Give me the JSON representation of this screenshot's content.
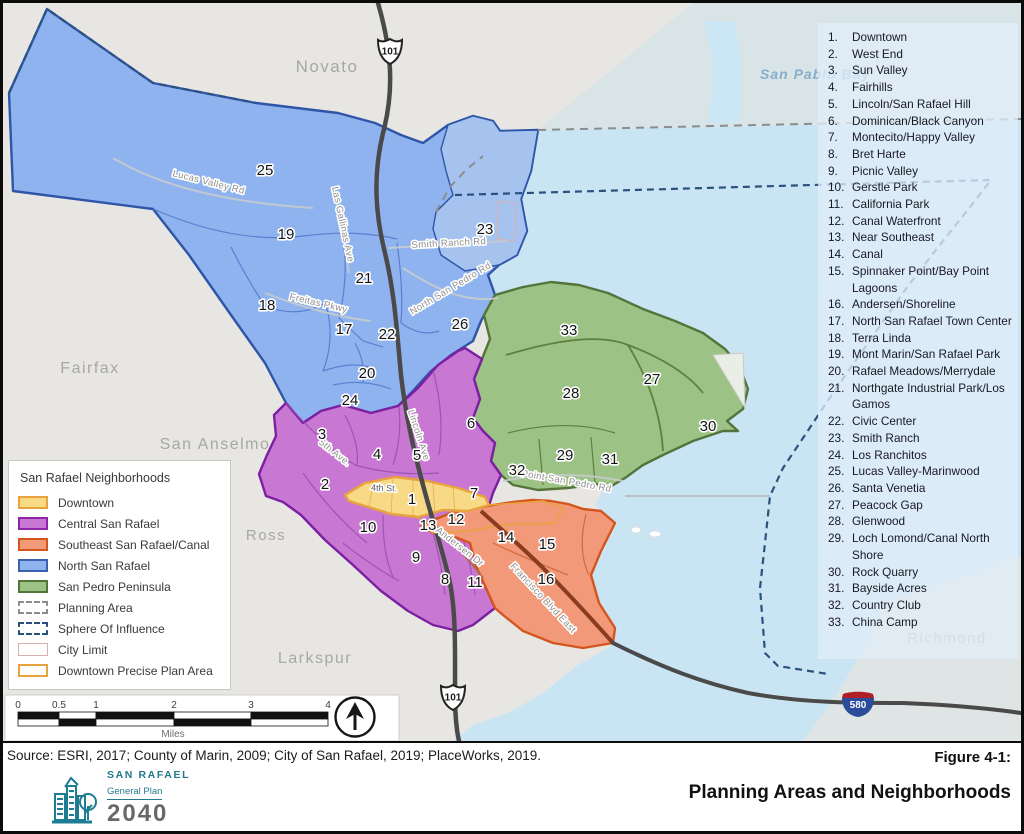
{
  "figure": {
    "label": "Figure 4-1:",
    "title": "Planning Areas and Neighborhoods",
    "source": "Source: ESRI, 2017; County of Marin, 2009; City of San Rafael, 2019; PlaceWorks, 2019."
  },
  "logo": {
    "city": "SAN RAFAEL",
    "subtitle": "General Plan",
    "year": "2040"
  },
  "legend": {
    "title": "San Rafael Neighborhoods",
    "items": [
      {
        "label": "Downtown",
        "type": "fill",
        "fill": "#F8D984",
        "border": "#E8A33D"
      },
      {
        "label": "Central San Rafael",
        "type": "fill",
        "fill": "#C878D2",
        "border": "#8E24AA"
      },
      {
        "label": "Southeast San Rafael/Canal",
        "type": "fill",
        "fill": "#F2997A",
        "border": "#D4551E"
      },
      {
        "label": "North San Rafael",
        "type": "fill",
        "fill": "#8FB3EE",
        "border": "#3D5FAE"
      },
      {
        "label": "San Pedro Peninsula",
        "type": "fill",
        "fill": "#9DC285",
        "border": "#55743B"
      },
      {
        "label": "Planning Area",
        "type": "dashed",
        "border": "#8C8C8C"
      },
      {
        "label": "Sphere Of Influence",
        "type": "dashed",
        "border": "#2B517E"
      },
      {
        "label": "City Limit",
        "type": "outline",
        "border": "#D8AFAF"
      },
      {
        "label": "Downtown Precise Plan Area",
        "type": "outline",
        "border": "#E8A33D"
      }
    ]
  },
  "neighborhoods": [
    {
      "n": 1,
      "name": "Downtown",
      "x": 409,
      "y": 496
    },
    {
      "n": 2,
      "name": "West End",
      "x": 322,
      "y": 481
    },
    {
      "n": 3,
      "name": "Sun Valley",
      "x": 319,
      "y": 431
    },
    {
      "n": 4,
      "name": "Fairhills",
      "x": 374,
      "y": 451
    },
    {
      "n": 5,
      "name": "Lincoln/San Rafael Hill",
      "x": 414,
      "y": 452
    },
    {
      "n": 6,
      "name": "Dominican/Black Canyon",
      "x": 468,
      "y": 420
    },
    {
      "n": 7,
      "name": "Montecito/Happy Valley",
      "x": 471,
      "y": 490
    },
    {
      "n": 8,
      "name": "Bret Harte",
      "x": 442,
      "y": 576
    },
    {
      "n": 9,
      "name": "Picnic Valley",
      "x": 413,
      "y": 554
    },
    {
      "n": 10,
      "name": "Gerstle Park",
      "x": 365,
      "y": 524
    },
    {
      "n": 11,
      "name": "California Park",
      "x": 472,
      "y": 579
    },
    {
      "n": 12,
      "name": "Canal Waterfront",
      "x": 453,
      "y": 516
    },
    {
      "n": 13,
      "name": "Near Southeast",
      "x": 425,
      "y": 522
    },
    {
      "n": 14,
      "name": "Canal",
      "x": 503,
      "y": 534
    },
    {
      "n": 15,
      "name": "Spinnaker Point/Bay Point Lagoons",
      "x": 544,
      "y": 541
    },
    {
      "n": 16,
      "name": "Andersen/Shoreline",
      "x": 543,
      "y": 576
    },
    {
      "n": 17,
      "name": "North San Rafael Town Center",
      "x": 341,
      "y": 326
    },
    {
      "n": 18,
      "name": "Terra Linda",
      "x": 264,
      "y": 302
    },
    {
      "n": 19,
      "name": "Mont Marin/San Rafael Park",
      "x": 283,
      "y": 231
    },
    {
      "n": 20,
      "name": "Rafael Meadows/Merrydale",
      "x": 364,
      "y": 370
    },
    {
      "n": 21,
      "name": "Northgate Industrial Park/Los Gamos",
      "x": 361,
      "y": 275
    },
    {
      "n": 22,
      "name": "Civic Center",
      "x": 384,
      "y": 331
    },
    {
      "n": 23,
      "name": "Smith Ranch",
      "x": 482,
      "y": 226
    },
    {
      "n": 24,
      "name": "Los Ranchitos",
      "x": 347,
      "y": 397
    },
    {
      "n": 25,
      "name": "Lucas Valley-Marinwood",
      "x": 262,
      "y": 167
    },
    {
      "n": 26,
      "name": "Santa Venetia",
      "x": 457,
      "y": 321
    },
    {
      "n": 27,
      "name": "Peacock Gap",
      "x": 649,
      "y": 376
    },
    {
      "n": 28,
      "name": "Glenwood",
      "x": 568,
      "y": 390
    },
    {
      "n": 29,
      "name": "Loch Lomond/Canal North Shore",
      "x": 562,
      "y": 452
    },
    {
      "n": 30,
      "name": "Rock Quarry",
      "x": 705,
      "y": 423
    },
    {
      "n": 31,
      "name": "Bayside Acres",
      "x": 607,
      "y": 456
    },
    {
      "n": 32,
      "name": "Country Club",
      "x": 514,
      "y": 467
    },
    {
      "n": 33,
      "name": "China Camp",
      "x": 566,
      "y": 327
    }
  ],
  "cities": [
    {
      "name": "Novato",
      "x": 324,
      "y": 69,
      "size": 17
    },
    {
      "name": "Fairfax",
      "x": 87,
      "y": 370,
      "size": 16
    },
    {
      "name": "San Anselmo",
      "x": 212,
      "y": 446,
      "size": 16
    },
    {
      "name": "Ross",
      "x": 263,
      "y": 537,
      "size": 15
    },
    {
      "name": "Larkspur",
      "x": 312,
      "y": 660,
      "size": 16
    },
    {
      "name": "Richmond",
      "x": 944,
      "y": 640,
      "size": 15
    }
  ],
  "bay_label": {
    "text": "San Pablo Bay",
    "x": 757,
    "y": 76
  },
  "roads": [
    {
      "text": "Lucas Valley Rd",
      "x": 205,
      "y": 182,
      "rot": 14
    },
    {
      "text": "Las Gallinas Ave",
      "x": 337,
      "y": 222,
      "rot": 78
    },
    {
      "text": "Smith Ranch Rd",
      "x": 446,
      "y": 243,
      "rot": -3
    },
    {
      "text": "Freitas Pkwy",
      "x": 315,
      "y": 303,
      "rot": 13
    },
    {
      "text": "North San Pedro Rd",
      "x": 449,
      "y": 288,
      "rot": -31
    },
    {
      "text": "Lincoln Ave",
      "x": 413,
      "y": 433,
      "rot": 72
    },
    {
      "text": "5th Ave.",
      "x": 330,
      "y": 452,
      "rot": 38
    },
    {
      "text": "4th St.",
      "x": 381,
      "y": 488,
      "rot": 2
    },
    {
      "text": "Andersen Dr",
      "x": 455,
      "y": 546,
      "rot": 38
    },
    {
      "text": "Francisco Blvd East",
      "x": 538,
      "y": 597,
      "rot": 47
    },
    {
      "text": "Point San Pedro Rd",
      "x": 563,
      "y": 481,
      "rot": 10
    }
  ],
  "shields": [
    {
      "system": "US",
      "label": "101",
      "x": 387,
      "y": 48
    },
    {
      "system": "US",
      "label": "101",
      "x": 450,
      "y": 694
    },
    {
      "system": "I",
      "label": "580",
      "x": 855,
      "y": 701
    }
  ],
  "scalebar": {
    "ticks": [
      "0",
      "0.5",
      "1",
      "2",
      "3",
      "4"
    ],
    "unit": "Miles"
  }
}
